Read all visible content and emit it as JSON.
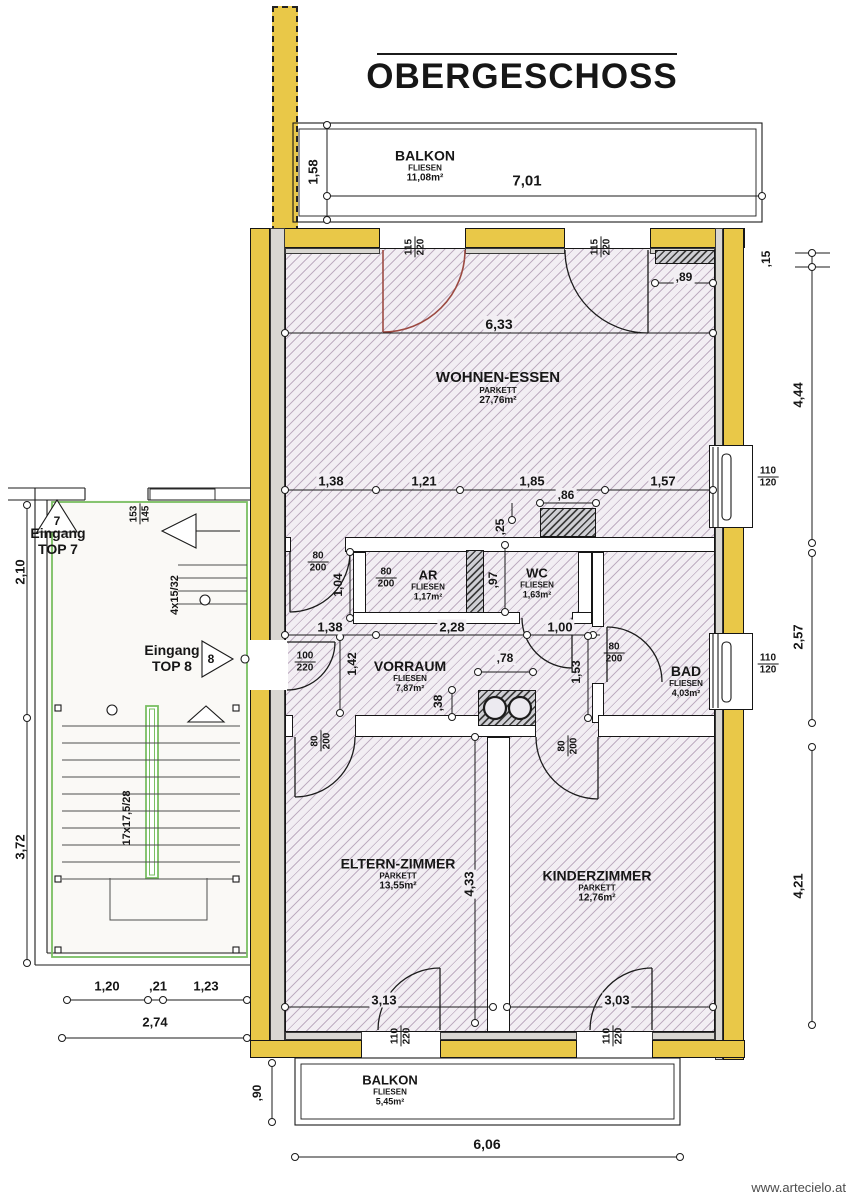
{
  "title": "OBERGESCHOSS",
  "watermark": "www.artecielo.at",
  "rooms": {
    "balkon_top": {
      "name": "BALKON",
      "finish": "FLIESEN",
      "area": "11,08m²"
    },
    "wohnen": {
      "name": "WOHNEN-ESSEN",
      "finish": "PARKETT",
      "area": "27,76m²"
    },
    "ar": {
      "name": "AR",
      "finish": "FLIESEN",
      "area": "1,17m²"
    },
    "wc": {
      "name": "WC",
      "finish": "FLIESEN",
      "area": "1,63m²"
    },
    "vorraum": {
      "name": "VORRAUM",
      "finish": "FLIESEN",
      "area": "7,87m²"
    },
    "bad": {
      "name": "BAD",
      "finish": "FLIESEN",
      "area": "4,03m²"
    },
    "eltern": {
      "name": "ELTERN-ZIMMER",
      "finish": "PARKETT",
      "area": "13,55m²"
    },
    "kinder": {
      "name": "KINDERZIMMER",
      "finish": "PARKETT",
      "area": "12,76m²"
    },
    "balkon_bottom": {
      "name": "BALKON",
      "finish": "FLIESEN",
      "area": "5,45m²"
    }
  },
  "entrances": {
    "label": "Eingang",
    "top7": "TOP 7",
    "num7": "7",
    "top8": "TOP 8",
    "num8": "8"
  },
  "stairs": {
    "main_run": "17x17,5/28",
    "upper_run": "4x15/32"
  },
  "openings": {
    "balcony_door_top": {
      "num": "115",
      "den": "220"
    },
    "window_right": {
      "num": "110",
      "den": "120"
    },
    "door_std": {
      "num": "80",
      "den": "200"
    },
    "entry_door": {
      "num": "100",
      "den": "220"
    },
    "balcony_door_bottom": {
      "num": "110",
      "den": "220"
    },
    "stair_window": {
      "num": "153",
      "den": "145"
    }
  },
  "dims": {
    "balkon_top_depth": "1,58",
    "balkon_top_width": "7,01",
    "niche_top": ",89",
    "right_offset": ",15",
    "right_upper": "4,44",
    "right_middle": "2,57",
    "right_lower": "4,21",
    "wohnen_width": "6,33",
    "hall_a": "1,38",
    "hall_b": "1,21",
    "hall_c": "1,85",
    "hall_d": "1,57",
    "shaft_w": ",86",
    "shaft_off": ",25",
    "wc_depth": ",97",
    "ar_door": "1,04",
    "vor_a": "1,38",
    "vor_b": "2,28",
    "vor_c": "1,00",
    "kamin_w": ",78",
    "step": ",38",
    "vor_d": "1,42",
    "niche_d": "1,53",
    "eltern_width": "3,13",
    "kinder_width": "3,03",
    "bed_depth": "4,33",
    "stair_upper": "2,10",
    "stair_lower": "3,72",
    "sw_a": "1,20",
    "sw_b": ",21",
    "sw_c": "1,23",
    "sw_total": "2,74",
    "balkon_b_depth": ",90",
    "balkon_b_width": "6,06"
  }
}
